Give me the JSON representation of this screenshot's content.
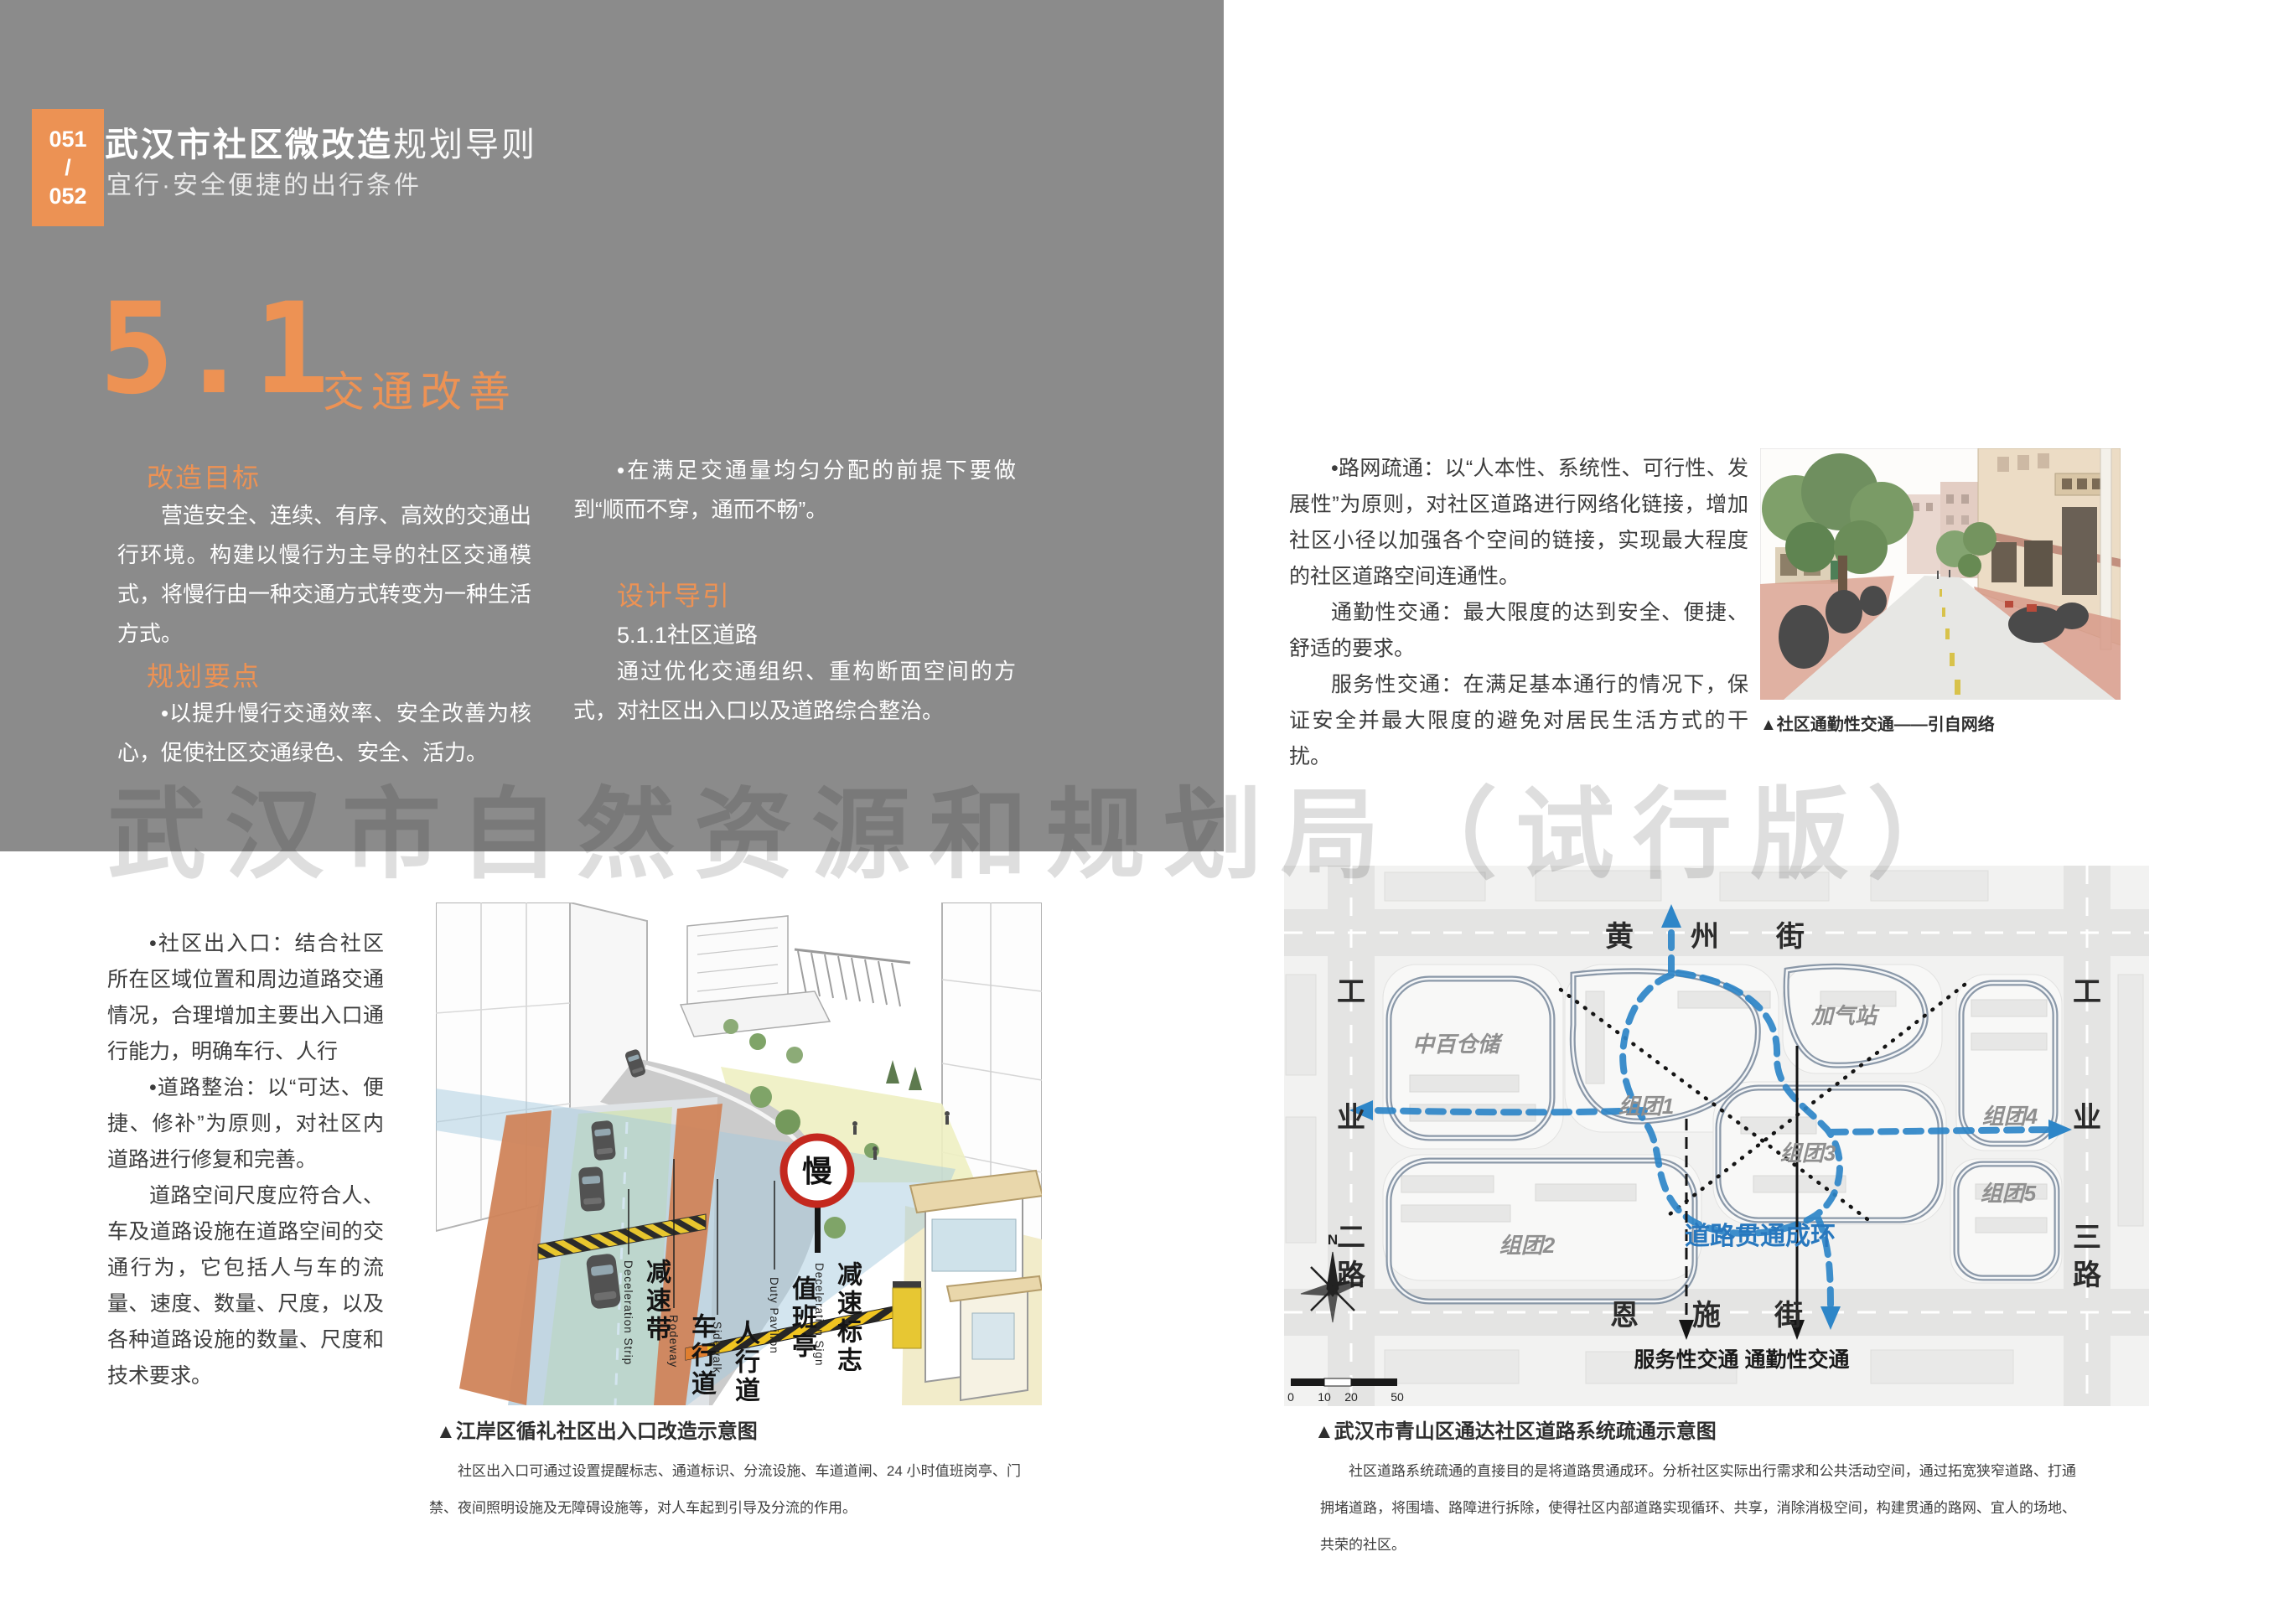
{
  "page": {
    "badge": {
      "top": "051",
      "divider": "/",
      "bottom": "052"
    },
    "header": {
      "title_bold": "武汉市社区微改造",
      "title_light": "规划导则",
      "subtitle": "宜行·安全便捷的出行条件"
    },
    "section": {
      "number": "5.1",
      "title": "交通改善"
    },
    "watermark": "武汉市自然资源和规划局（试行版）"
  },
  "left_panel": {
    "goal_heading": "改造目标",
    "goal_text": "营造安全、连续、有序、高效的交通出行环境。构建以慢行为主导的社区交通模式，将慢行由一种交通方式转变为一种生活方式。",
    "points_heading": "规划要点",
    "points_text": "•以提升慢行交通效率、安全改善为核心，促使社区交通绿色、安全、活力。",
    "mid_bullet": "•在满足交通量均匀分配的前提下要做到“顺而不穿，通而不畅”。",
    "guide_heading": "设计导引",
    "guide_sub": "5.1.1社区道路",
    "guide_text": "通过优化交通组织、重构断面空间的方式，对社区出入口以及道路综合整治。"
  },
  "right_page": {
    "para1": "•路网疏通：以“人本性、系统性、可行性、发展性”为原则，对社区道路进行网络化链接，增加社区小径以加强各个空间的链接，实现最大程度的社区道路空间连通性。",
    "para2": "通勤性交通：最大限度的达到安全、便捷、舒适的要求。",
    "para3": "服务性交通：在满足基本通行的情况下，保证安全并最大限度的避免对居民生活方式的干扰。",
    "photo_caption": "▲社区通勤性交通——引自网络"
  },
  "bottom_left": {
    "col_text_1": "•社区出入口：结合社区所在区域位置和周边道路交通情况，合理增加主要出入口通行能力，明确车行、人行",
    "col_text_2": "•道路整治：以“可达、便捷、修补”为原则，对社区内道路进行修复和完善。",
    "col_text_3": "道路空间尺度应符合人、车及道路设施在道路空间的交通行为，它包括人与车的流量、速度、数量、尺度，以及各种道路设施的数量、尺度和技术要求。",
    "caption": "▲江岸区循礼社区出入口改造示意图",
    "caption_text": "社区出入口可通过设置提醒标志、通道标识、分流设施、车道道闸、24 小时值班岗亭、门禁、夜间照明设施及无障碍设施等，对人车起到引导及分流的作用。"
  },
  "diagram": {
    "sign_text": "慢",
    "labels": [
      {
        "cn": "减速带",
        "en": "Deceleration  Strip"
      },
      {
        "cn": "车行道",
        "en": "Rodeway"
      },
      {
        "cn": "人行道",
        "en": "Sidewalk"
      },
      {
        "cn": "值班亭",
        "en": "Duty  Pavilion"
      },
      {
        "cn": "减速标志",
        "en": "Deceleration  Sign"
      }
    ]
  },
  "map": {
    "street_top": [
      "黄",
      "州",
      "街"
    ],
    "street_bottom": [
      "恩",
      "施",
      "街"
    ],
    "street_left": [
      "工",
      "业",
      "二",
      "路"
    ],
    "street_right": [
      "工",
      "业",
      "三",
      "路"
    ],
    "areas": [
      "中百仓储",
      "加气站",
      "组团1",
      "组团2",
      "组团3",
      "组团4",
      "组团5"
    ],
    "ring_label": "道路贯通成环",
    "legend_service": "服务性交通",
    "legend_commute": "通勤性交通",
    "north": "N",
    "scale_ticks": [
      "0",
      "10",
      "20",
      "50"
    ],
    "caption": "▲武汉市青山区通达社区道路系统疏通示意图",
    "caption_text": "社区道路系统疏通的直接目的是将道路贯通成环。分析社区实际出行需求和公共活动空间，通过拓宽狭窄道路、打通拥堵道路，将围墙、路障进行拆除，使得社区内部道路实现循环、共享，消除消极空间，构建贯通的路网、宜人的场地、共荣的社区。"
  },
  "colors": {
    "accent_orange": "#ed9254",
    "panel_gray": "#8b8b8b",
    "route_blue": "#2e86c8",
    "sign_red": "#c4281e",
    "hazard_yellow": "#f0c420"
  }
}
